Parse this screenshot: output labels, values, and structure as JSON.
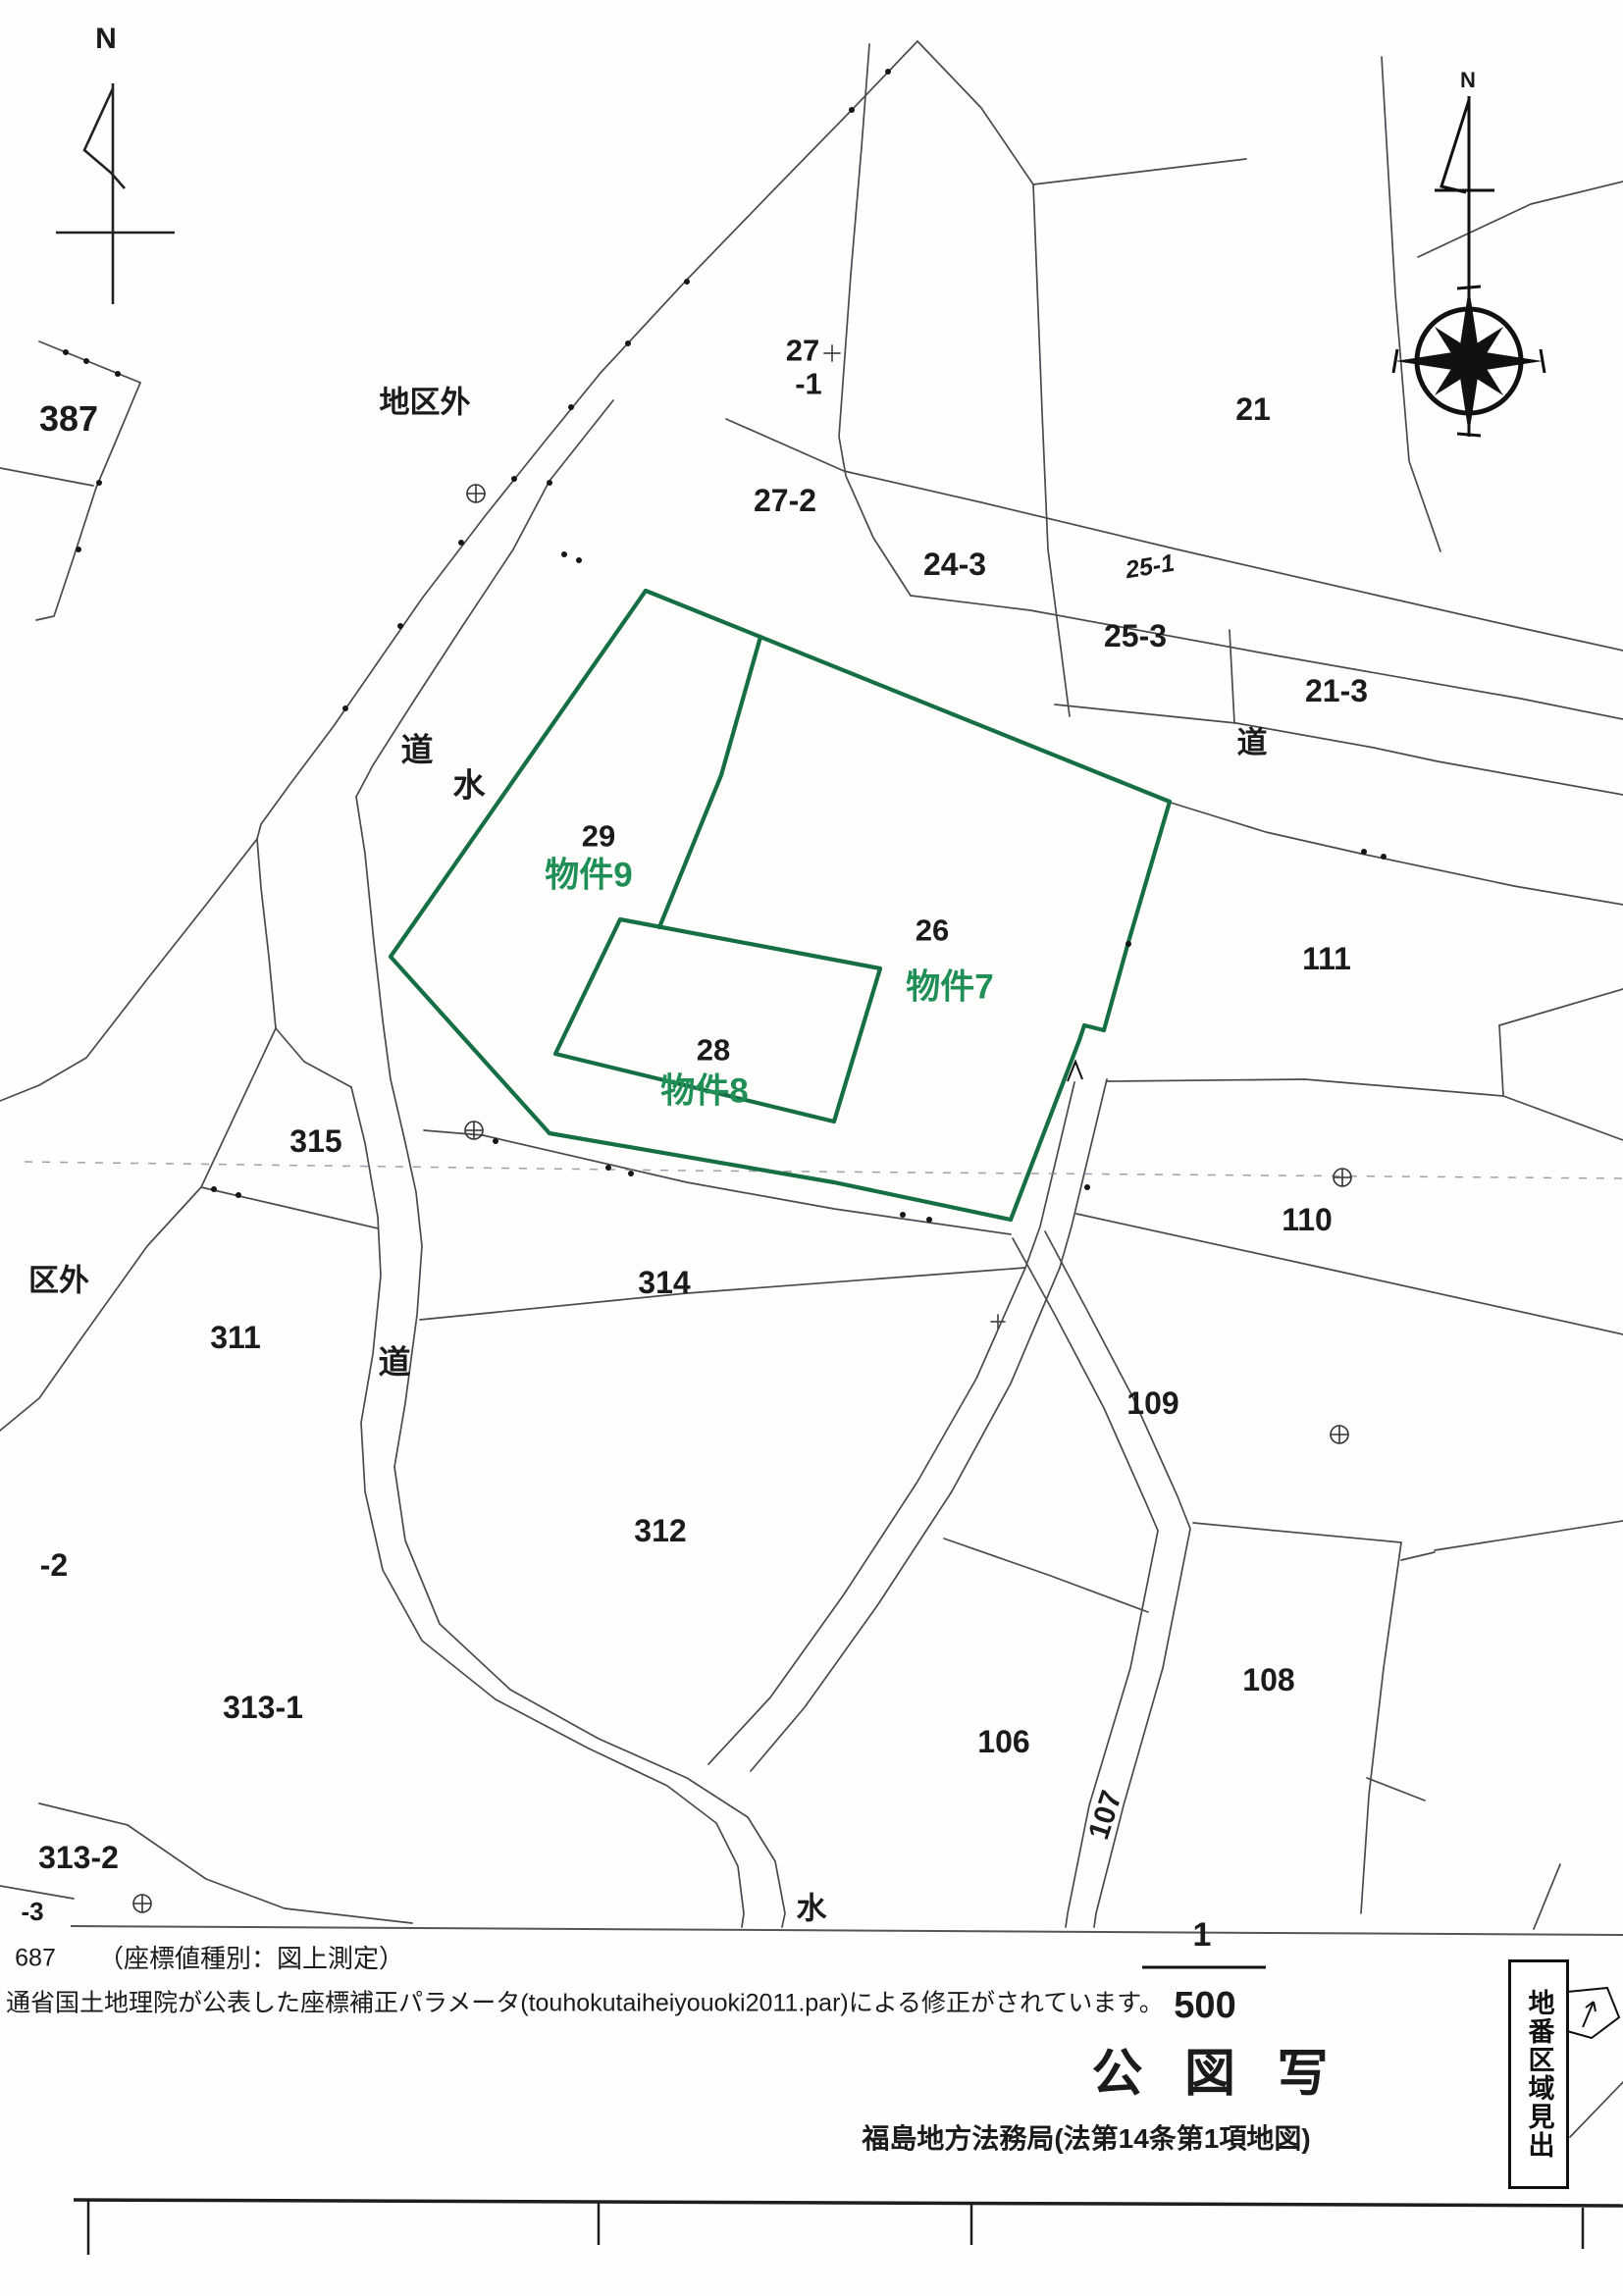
{
  "doc": {
    "type": "cadastral-map-copy",
    "title": "公 図 写",
    "bureau": "福島地方法務局(法第14条第1項地図)",
    "scale_numerator": "1",
    "scale_denominator": "500",
    "sheet_number": "687",
    "coord_note": "（座標値種別：図上測定）",
    "correction_note": "通省国土地理院が公表した座標補正パラメータ(touhokutaiheiyouoki2011.par)による修正がされています。",
    "side_tab": "地番区域見出"
  },
  "colors": {
    "green_line": "#156e44",
    "green_text": "#1f8f55",
    "boundary_line": "#4a4a4d",
    "text": "#1b1b1b"
  },
  "compass": {
    "north_label_left": "N",
    "north_label_right": "N"
  },
  "labels": {
    "n_left": "N",
    "n_right": "N",
    "p387": "387",
    "chikugai": "地区外",
    "p27": "27",
    "p27m1": "-1",
    "p21": "21",
    "p27_2": "27-2",
    "p24_3": "24-3",
    "p25_1": "25-1",
    "p25_3": "25-3",
    "p21_3": "21-3",
    "michi_ne": "道",
    "michi_nw": "道",
    "mizu_nw": "水",
    "p29": "29",
    "bukken9": "物件9",
    "p26": "26",
    "bukken7": "物件7",
    "p28": "28",
    "bukken8": "物件8",
    "p111": "111",
    "p315": "315",
    "kugai": "区外",
    "p311": "311",
    "michi_w": "道",
    "p314": "314",
    "p110": "110",
    "p109": "109",
    "p312": "312",
    "pm2": "-2",
    "p313_1": "313-1",
    "p106": "106",
    "p107": "107",
    "p108": "108",
    "p313_2": "313-2",
    "pm3": "-3",
    "mizu_s": "水",
    "f687": "687",
    "coordnote": "（座標値種別：図上測定）",
    "corrnote": "通省国土地理院が公表した座標補正パラメータ(touhokutaiheiyouoki2011.par)による修正がされています。",
    "scale_num": "1",
    "scale_den": "500",
    "title": "公 図 写",
    "bureau": "福島地方法務局(法第14条第1項地図)",
    "side_tab": "地番区域見出"
  }
}
